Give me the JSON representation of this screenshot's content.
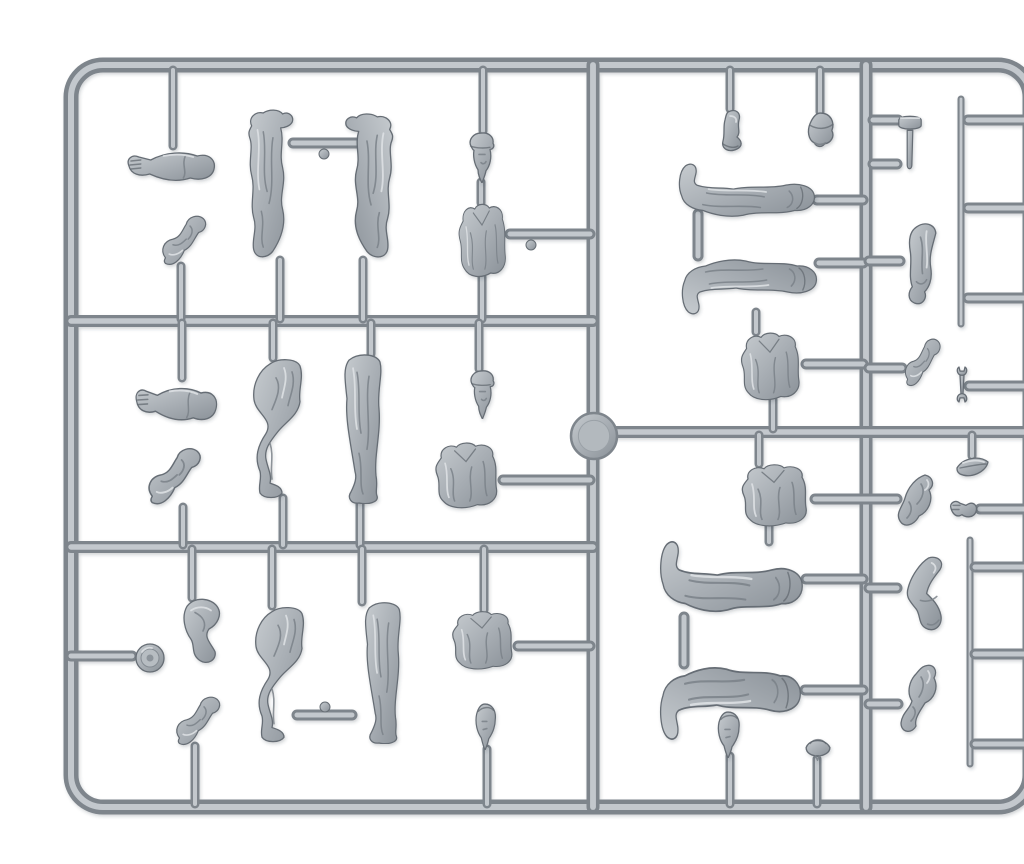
{
  "scene": {
    "subject": "gray injection-molded plastic model sprue with military figure parts on white background",
    "background": "#ffffff",
    "colors": {
      "plastic_light": "#c6cbcf",
      "plastic_base": "#a8aeb4",
      "plastic_dark": "#8a9198",
      "pipe_dark": "#7e858c",
      "pipe_light": "#c3c8cd",
      "outline": "#666d74",
      "shadow": "#3a4046"
    },
    "frame": {
      "x": 31,
      "y": 49,
      "width": 959,
      "height": 742,
      "radius": 32,
      "outer_w": 15,
      "inner_w": 6
    },
    "injection_point": {
      "cx": 554,
      "cy": 420,
      "r": 23
    },
    "runners": [
      {
        "x1": 553,
        "y1": 49,
        "x2": 553,
        "y2": 791,
        "w": 13
      },
      {
        "x1": 826,
        "y1": 49,
        "x2": 826,
        "y2": 791,
        "w": 13
      },
      {
        "x1": 31,
        "y1": 305,
        "x2": 553,
        "y2": 305,
        "w": 12
      },
      {
        "x1": 31,
        "y1": 531,
        "x2": 553,
        "y2": 531,
        "w": 12
      },
      {
        "x1": 553,
        "y1": 416,
        "x2": 990,
        "y2": 416,
        "w": 12
      },
      {
        "x1": 31,
        "y1": 640,
        "x2": 92,
        "y2": 640,
        "w": 11
      }
    ],
    "rods": [
      {
        "x1": 921,
        "y1": 83,
        "x2": 921,
        "y2": 308,
        "w": 7
      },
      {
        "x1": 930,
        "y1": 524,
        "x2": 930,
        "y2": 748,
        "w": 7
      }
    ],
    "stubs": [
      {
        "x1": 133,
        "y1": 54,
        "x2": 133,
        "y2": 130
      },
      {
        "x1": 141,
        "y1": 250,
        "x2": 141,
        "y2": 303
      },
      {
        "x1": 142,
        "y1": 307,
        "x2": 142,
        "y2": 362
      },
      {
        "x1": 143,
        "y1": 491,
        "x2": 143,
        "y2": 529
      },
      {
        "x1": 152,
        "y1": 533,
        "x2": 152,
        "y2": 582
      },
      {
        "x1": 155,
        "y1": 730,
        "x2": 155,
        "y2": 788
      },
      {
        "x1": 240,
        "y1": 244,
        "x2": 240,
        "y2": 303
      },
      {
        "x1": 323,
        "y1": 244,
        "x2": 323,
        "y2": 303
      },
      {
        "x1": 233,
        "y1": 307,
        "x2": 233,
        "y2": 342
      },
      {
        "x1": 331,
        "y1": 307,
        "x2": 331,
        "y2": 338
      },
      {
        "x1": 243,
        "y1": 482,
        "x2": 243,
        "y2": 529
      },
      {
        "x1": 320,
        "y1": 486,
        "x2": 320,
        "y2": 529
      },
      {
        "x1": 232,
        "y1": 533,
        "x2": 232,
        "y2": 590
      },
      {
        "x1": 322,
        "y1": 533,
        "x2": 322,
        "y2": 586
      },
      {
        "x1": 443,
        "y1": 54,
        "x2": 443,
        "y2": 115
      },
      {
        "x1": 441,
        "y1": 166,
        "x2": 441,
        "y2": 187
      },
      {
        "x1": 442,
        "y1": 261,
        "x2": 442,
        "y2": 303
      },
      {
        "x1": 439,
        "y1": 307,
        "x2": 439,
        "y2": 353
      },
      {
        "x1": 444,
        "y1": 533,
        "x2": 444,
        "y2": 594
      },
      {
        "x1": 447,
        "y1": 733,
        "x2": 447,
        "y2": 788
      },
      {
        "x1": 690,
        "y1": 54,
        "x2": 690,
        "y2": 93
      },
      {
        "x1": 780,
        "y1": 54,
        "x2": 780,
        "y2": 96
      },
      {
        "x1": 716,
        "y1": 296,
        "x2": 716,
        "y2": 316
      },
      {
        "x1": 733,
        "y1": 384,
        "x2": 733,
        "y2": 413
      },
      {
        "x1": 719,
        "y1": 419,
        "x2": 719,
        "y2": 448
      },
      {
        "x1": 729,
        "y1": 510,
        "x2": 729,
        "y2": 526
      },
      {
        "x1": 932,
        "y1": 419,
        "x2": 932,
        "y2": 440
      },
      {
        "x1": 690,
        "y1": 740,
        "x2": 690,
        "y2": 788
      },
      {
        "x1": 777,
        "y1": 743,
        "x2": 777,
        "y2": 788
      }
    ],
    "gates": [
      {
        "x1": 470,
        "y1": 218,
        "x2": 550,
        "y2": 218
      },
      {
        "x1": 463,
        "y1": 464,
        "x2": 550,
        "y2": 464
      },
      {
        "x1": 478,
        "y1": 630,
        "x2": 550,
        "y2": 630
      },
      {
        "x1": 253,
        "y1": 127,
        "x2": 317,
        "y2": 127
      },
      {
        "x1": 257,
        "y1": 699,
        "x2": 312,
        "y2": 699
      },
      {
        "x1": 777,
        "y1": 184,
        "x2": 823,
        "y2": 184
      },
      {
        "x1": 779,
        "y1": 247,
        "x2": 823,
        "y2": 247
      },
      {
        "x1": 829,
        "y1": 245,
        "x2": 860,
        "y2": 245
      },
      {
        "x1": 766,
        "y1": 348,
        "x2": 823,
        "y2": 348
      },
      {
        "x1": 829,
        "y1": 352,
        "x2": 862,
        "y2": 352
      },
      {
        "x1": 929,
        "y1": 370,
        "x2": 988,
        "y2": 370
      },
      {
        "x1": 775,
        "y1": 483,
        "x2": 857,
        "y2": 483
      },
      {
        "x1": 940,
        "y1": 493,
        "x2": 988,
        "y2": 493
      },
      {
        "x1": 766,
        "y1": 563,
        "x2": 823,
        "y2": 563
      },
      {
        "x1": 829,
        "y1": 572,
        "x2": 857,
        "y2": 572
      },
      {
        "x1": 765,
        "y1": 674,
        "x2": 823,
        "y2": 674
      },
      {
        "x1": 829,
        "y1": 688,
        "x2": 858,
        "y2": 688
      },
      {
        "x1": 833,
        "y1": 104,
        "x2": 858,
        "y2": 104
      },
      {
        "x1": 833,
        "y1": 148,
        "x2": 857,
        "y2": 148
      },
      {
        "x1": 928,
        "y1": 104,
        "x2": 988,
        "y2": 104
      },
      {
        "x1": 928,
        "y1": 192,
        "x2": 988,
        "y2": 192
      },
      {
        "x1": 928,
        "y1": 282,
        "x2": 988,
        "y2": 282
      },
      {
        "x1": 935,
        "y1": 551,
        "x2": 986,
        "y2": 551
      },
      {
        "x1": 935,
        "y1": 638,
        "x2": 986,
        "y2": 638
      },
      {
        "x1": 935,
        "y1": 728,
        "x2": 986,
        "y2": 728
      },
      {
        "x1": 658,
        "y1": 198,
        "x2": 658,
        "y2": 240
      },
      {
        "x1": 644,
        "y1": 601,
        "x2": 644,
        "y2": 648
      }
    ],
    "gate_knobs": [
      {
        "cx": 284,
        "cy": 138,
        "r": 5
      },
      {
        "cx": 285,
        "cy": 691,
        "r": 5
      },
      {
        "cx": 491,
        "cy": 229,
        "r": 5
      }
    ],
    "parts": [
      {
        "name": "arm-open-hand-1",
        "type": "arm-open",
        "x": 84,
        "y": 128,
        "w": 94,
        "h": 42
      },
      {
        "name": "arm-bent-fist-1",
        "type": "arm-bent",
        "x": 116,
        "y": 197,
        "w": 52,
        "h": 56
      },
      {
        "name": "arm-open-hand-2",
        "type": "arm-open",
        "x": 92,
        "y": 362,
        "w": 88,
        "h": 48,
        "rot": 3
      },
      {
        "name": "arm-bent-fist-2",
        "type": "arm-bent",
        "x": 101,
        "y": 429,
        "w": 62,
        "h": 64
      },
      {
        "name": "single-bent-leg",
        "type": "thigh",
        "x": 135,
        "y": 580,
        "w": 52,
        "h": 68
      },
      {
        "name": "rolled-item",
        "type": "knob",
        "x": 94,
        "y": 626,
        "w": 32,
        "h": 32
      },
      {
        "name": "arm-bent-fist-3",
        "type": "arm-bent",
        "x": 130,
        "y": 678,
        "w": 52,
        "h": 55
      },
      {
        "name": "greatcoat-half-left",
        "type": "coat",
        "x": 202,
        "y": 92,
        "w": 58,
        "h": 154
      },
      {
        "name": "greatcoat-half-right",
        "type": "coat",
        "x": 298,
        "y": 96,
        "w": 62,
        "h": 150,
        "flip": true
      },
      {
        "name": "head-with-cap-1",
        "type": "head-cap",
        "x": 427,
        "y": 114,
        "w": 30,
        "h": 53
      },
      {
        "name": "torso-jacket-1",
        "type": "torso",
        "x": 413,
        "y": 185,
        "w": 58,
        "h": 78
      },
      {
        "name": "head-with-cap-2",
        "type": "head-cap",
        "x": 428,
        "y": 352,
        "w": 29,
        "h": 51
      },
      {
        "name": "legs-bent-pair-1",
        "type": "legs-bent",
        "x": 208,
        "y": 340,
        "w": 62,
        "h": 144
      },
      {
        "name": "legs-straight-pair-1",
        "type": "legs-straight",
        "x": 293,
        "y": 336,
        "w": 55,
        "h": 152
      },
      {
        "name": "torso-jacket-2",
        "type": "torso",
        "x": 388,
        "y": 424,
        "w": 76,
        "h": 70
      },
      {
        "name": "legs-bent-pair-2",
        "type": "legs-bent",
        "x": 210,
        "y": 588,
        "w": 62,
        "h": 140
      },
      {
        "name": "legs-straight-pair-2",
        "type": "legs-straight",
        "x": 314,
        "y": 584,
        "w": 53,
        "h": 144
      },
      {
        "name": "torso-jacket-3",
        "type": "torso",
        "x": 405,
        "y": 593,
        "w": 74,
        "h": 62
      },
      {
        "name": "head-bare-1",
        "type": "head-bare",
        "x": 431,
        "y": 685,
        "w": 28,
        "h": 49
      },
      {
        "name": "ankle-boot",
        "type": "boot",
        "x": 676,
        "y": 92,
        "w": 30,
        "h": 44
      },
      {
        "name": "ushanka-hat",
        "type": "ushanka",
        "x": 765,
        "y": 94,
        "w": 31,
        "h": 38
      },
      {
        "name": "hammer-tool",
        "type": "hammer",
        "x": 856,
        "y": 96,
        "w": 28,
        "h": 59
      },
      {
        "name": "legs-lying-1",
        "type": "legs-lying",
        "x": 634,
        "y": 146,
        "w": 144,
        "h": 60
      },
      {
        "name": "legs-lying-2",
        "type": "legs-lying",
        "x": 637,
        "y": 238,
        "w": 143,
        "h": 62,
        "flipv": true
      },
      {
        "name": "arm-sleeve-down",
        "type": "arm-down",
        "x": 858,
        "y": 205,
        "w": 46,
        "h": 86
      },
      {
        "name": "torso-jacket-4",
        "type": "torso",
        "x": 694,
        "y": 314,
        "w": 72,
        "h": 72
      },
      {
        "name": "arm-bent-fist-4",
        "type": "arm-bent",
        "x": 860,
        "y": 320,
        "w": 42,
        "h": 54
      },
      {
        "name": "wrench-tool",
        "type": "wrench",
        "x": 915,
        "y": 350,
        "w": 14,
        "h": 37
      },
      {
        "name": "torso-vest",
        "type": "torso",
        "x": 694,
        "y": 446,
        "w": 80,
        "h": 66
      },
      {
        "name": "folded-cloth",
        "type": "mitt",
        "x": 855,
        "y": 456,
        "w": 42,
        "h": 58
      },
      {
        "name": "small-pod",
        "type": "leaf",
        "x": 915,
        "y": 437,
        "w": 36,
        "h": 28
      },
      {
        "name": "tiny-hand",
        "type": "hand-tiny",
        "x": 907,
        "y": 480,
        "w": 34,
        "h": 26
      },
      {
        "name": "legs-lying-3",
        "type": "legs-lying",
        "x": 615,
        "y": 523,
        "w": 151,
        "h": 80
      },
      {
        "name": "gauntlet-arm",
        "type": "glove-arm",
        "x": 855,
        "y": 539,
        "w": 53,
        "h": 79
      },
      {
        "name": "legs-lying-4",
        "type": "legs-lying",
        "x": 615,
        "y": 644,
        "w": 149,
        "h": 82,
        "flipv": true
      },
      {
        "name": "bent-leg-piece",
        "type": "boot-bent",
        "x": 857,
        "y": 647,
        "w": 48,
        "h": 72
      },
      {
        "name": "head-bare-2",
        "type": "head-bare",
        "x": 673,
        "y": 693,
        "w": 30,
        "h": 49
      },
      {
        "name": "pilotka-cap",
        "type": "pilotka",
        "x": 762,
        "y": 714,
        "w": 31,
        "h": 31
      }
    ]
  }
}
